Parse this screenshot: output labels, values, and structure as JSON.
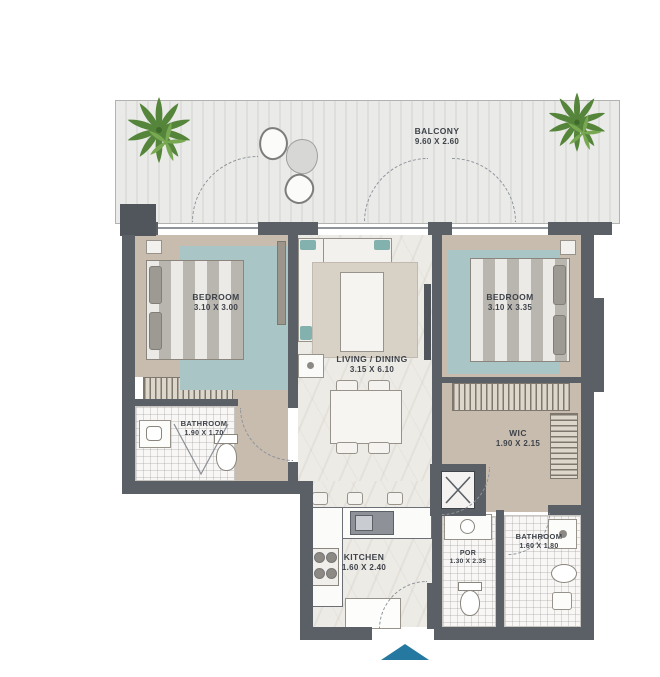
{
  "title": "2 Bedroom Apartment Floor Plan",
  "rooms": {
    "balcony": {
      "name": "BALCONY",
      "dims": "9.60 X 2.60"
    },
    "bedroom_left": {
      "name": "BEDROOM",
      "dims": "3.10 X 3.00"
    },
    "bedroom_right": {
      "name": "BEDROOM",
      "dims": "3.10 X 3.35"
    },
    "living_dining": {
      "name": "LIVING / DINING",
      "dims": "3.15 X 6.10"
    },
    "bathroom_left": {
      "name": "BATHROOM",
      "dims": "1.90 X 1.70"
    },
    "wic": {
      "name": "WIC",
      "dims": "1.90 X 2.15"
    },
    "kitchen": {
      "name": "KITCHEN",
      "dims": "1.60 X 2.40"
    },
    "por": {
      "name": "POR",
      "dims": "1.30 X 2.35"
    },
    "bathroom_right": {
      "name": "BATHROOM",
      "dims": "1.60 X 1.80"
    }
  },
  "colors": {
    "wall": "#5b6066",
    "floor_tan": "#c8bcae",
    "floor_marble": "#edebe6",
    "rug_teal": "#a9c5c6",
    "balcony_floor": "#e8e8e6",
    "plant_green": "#55853a",
    "entry_arrow": "#2579a1",
    "label_text": "#3e434a"
  }
}
